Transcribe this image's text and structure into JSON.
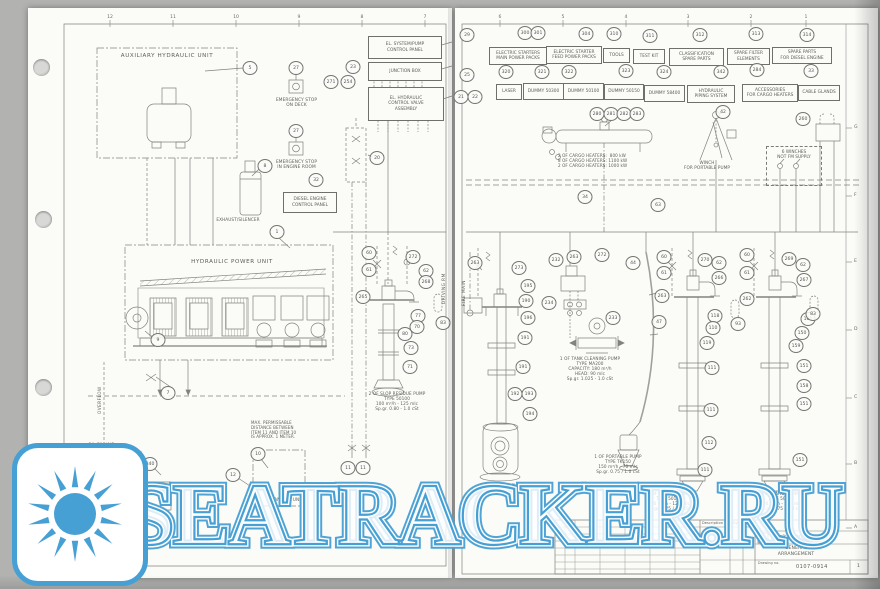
{
  "watermark": {
    "text": "SEATRACKER.RU",
    "accent": "#47a0d4"
  },
  "palette": {
    "paper": "#fbfbf8",
    "backdrop": "#b2b2b0",
    "ink": "#5c5c58",
    "line": "#82827e"
  },
  "grid": {
    "left_top_numbers": [
      [
        "12",
        110
      ],
      [
        "11",
        173
      ],
      [
        "10",
        236
      ],
      [
        "9",
        299
      ],
      [
        "8",
        362
      ],
      [
        "7",
        425
      ]
    ],
    "right_top_numbers": [
      [
        "6",
        500
      ],
      [
        "5",
        563
      ],
      [
        "4",
        626
      ],
      [
        "3",
        688
      ],
      [
        "2",
        751
      ],
      [
        "1",
        806
      ]
    ],
    "right_side_letters": [
      [
        "G",
        128
      ],
      [
        "F",
        196
      ],
      [
        "E",
        262
      ],
      [
        "D",
        330
      ],
      [
        "C",
        398
      ],
      [
        "B",
        464
      ],
      [
        "A",
        528
      ]
    ]
  },
  "left_labels": {
    "aux_title": "AUXILIARY HYDRAULIC UNIT",
    "esd_deck": "EMERGENCY STOP\nON DECK",
    "esd_engine": "EMERGENCY STOP\nIN ENGINE ROOM",
    "exhaust": "EXHAUST/SILENCER",
    "diesel_panel": "DIESEL ENGINE\nCONTROL PANEL",
    "el_panel": "EL. SYSTEM/PUMP\nCONTROL PANEL",
    "junction_box": "JUNCTION BOX",
    "el_hydraulic": "EL. HYDRAULIC\nCONTROL VALVE\nASSEMBLY",
    "hpu_title": "HYDRAULIC POWER UNIT",
    "overflow": "OVERFLOW",
    "oil_filling": "OIL FILLING",
    "max_note": "MAX. PERMISSABLE\nDISTANCE BETWEEN\nITEM 11 AND ITEM 10\nIS APPROX. 1 METER.",
    "transfer_unit": "TRANSFER UNIT",
    "oil_tank": "HYDR. OIL\nST. TANK",
    "slop_note": "2 OF SLOP RESIDUE PUMP\nTYPE 50100\n100 m³/h - 125 mlc\nSp.gr. 0.80 - 1.0 cSt",
    "compartment": "DRIVING RM"
  },
  "right_labels": {
    "fire_main": "FIRE MAIN",
    "heaters_note": "2 OF CARGO HEATERS:  800 kW\n8 OF CARGO HEATERS: 1100 kW\n2 OF CARGO HEATERS: 1000 kW",
    "winch": "WINCH\nFOR PORTABLE PUMP",
    "winches_box": "6 WINCHES\nNOT FM SUPPLY",
    "tank_cleaning_note": "1 OF TANK CLEANING PUMP\nTYPE MA200\nCAPACITY: 180 m³/h\nHEAD: 90 mlc\nSp.gr. 1.025 - 1.0 cSt",
    "portable_note": "1 OF PORTABLE PUMP\nTYPE TK150\n150 m³/h - 70 mlc\nSp.gr. 0.75 / 1.0 cSt",
    "cargo1_note": "2 OF CARGO PUMPS\nTYPE 50150\n300 m³/h - 125 mlc\nSp.gr. 0.75 / 1.0 cSt",
    "cargo2_note": "12 OF CARGO PUMPS\nTYPE 50300\n850 m³/h - 125 mlc\nSp.gr. 0.75 / 1.0 cSt",
    "ballast_note": "2 OF BALLAST PUMPS"
  },
  "title_block": {
    "company": "Frank Mohn AS",
    "doc_title": "GENERAL\nARRANGEMENT",
    "drawing_no": "0107-0914",
    "rev": "1",
    "col_description": "Description",
    "col_sign": "Sign",
    "col_date": "Date",
    "drawing_no_label": "Drawing no."
  },
  "parts_boxes": [
    {
      "label": "ELECTRIC STARTERS\nMAIN POWER PACKS",
      "x": 489,
      "y": 47,
      "w": 54,
      "h": 14,
      "nums": [
        [
          "300",
          525,
          33
        ],
        [
          "301",
          538,
          33
        ]
      ]
    },
    {
      "label": "ELECTRIC STARTER\nFEED POWER PACKS",
      "x": 546,
      "y": 46,
      "w": 52,
      "h": 14,
      "nums": [
        [
          "304",
          586,
          34
        ]
      ]
    },
    {
      "label": "TOOLS",
      "x": 603,
      "y": 48,
      "w": 23,
      "h": 11,
      "nums": [
        [
          "310",
          614,
          34
        ]
      ]
    },
    {
      "label": "TEST KIT",
      "x": 633,
      "y": 49,
      "w": 28,
      "h": 11,
      "nums": [
        [
          "311",
          650,
          36
        ]
      ]
    },
    {
      "label": "CLASSIFICATION\nSPARE PARTS",
      "x": 669,
      "y": 48,
      "w": 51,
      "h": 14,
      "nums": [
        [
          "312",
          700,
          35
        ]
      ]
    },
    {
      "label": "SPARE FILTER\nELEMENTS",
      "x": 727,
      "y": 48,
      "w": 39,
      "h": 13,
      "nums": [
        [
          "313",
          756,
          34
        ]
      ]
    },
    {
      "label": "SPARE PARTS\nFOR DIESEL ENGINE",
      "x": 772,
      "y": 47,
      "w": 56,
      "h": 13,
      "nums": [
        [
          "314",
          807,
          35
        ]
      ]
    },
    {
      "label": "LASER",
      "x": 496,
      "y": 84,
      "w": 22,
      "h": 12,
      "nums": [
        [
          "320",
          506,
          72
        ]
      ]
    },
    {
      "label": "DUMMY 50300",
      "x": 523,
      "y": 83,
      "w": 37,
      "h": 13,
      "nums": [
        [
          "321",
          542,
          72
        ]
      ]
    },
    {
      "label": "DUMMY 50100",
      "x": 563,
      "y": 83,
      "w": 37,
      "h": 13,
      "nums": [
        [
          "322",
          569,
          72
        ]
      ]
    },
    {
      "label": "DUMMY 50150",
      "x": 604,
      "y": 84,
      "w": 36,
      "h": 12,
      "nums": [
        [
          "323",
          626,
          71
        ]
      ]
    },
    {
      "label": "DUMMY 58400",
      "x": 644,
      "y": 85,
      "w": 37,
      "h": 13,
      "nums": [
        [
          "324",
          664,
          72
        ]
      ]
    },
    {
      "label": "HYDRAULIC\nPIPING SYSTEM",
      "x": 687,
      "y": 85,
      "w": 44,
      "h": 14,
      "nums": [
        [
          "342",
          721,
          72
        ]
      ]
    },
    {
      "label": "ACCESSORIES\nFOR CARGO HEATERS",
      "x": 742,
      "y": 84,
      "w": 52,
      "h": 14,
      "nums": [
        [
          "284",
          757,
          70
        ]
      ]
    },
    {
      "label": "CABLE GLANDS",
      "x": 798,
      "y": 85,
      "w": 38,
      "h": 12,
      "nums": [
        [
          "33",
          811,
          71
        ]
      ]
    }
  ],
  "callouts": [
    [
      "5",
      250,
      68
    ],
    [
      "27",
      296,
      68
    ],
    [
      "27",
      296,
      131
    ],
    [
      "8",
      265,
      166
    ],
    [
      "32",
      316,
      180
    ],
    [
      "23",
      353,
      67
    ],
    [
      "254",
      348,
      82
    ],
    [
      "271",
      331,
      82
    ],
    [
      "20",
      377,
      158
    ],
    [
      "1",
      277,
      232
    ],
    [
      "9",
      158,
      340
    ],
    [
      "7",
      168,
      393
    ],
    [
      "340",
      150,
      464
    ],
    [
      "10",
      258,
      454
    ],
    [
      "12",
      233,
      475
    ],
    [
      "11",
      348,
      468
    ],
    [
      "11",
      363,
      468
    ],
    [
      "60",
      369,
      253
    ],
    [
      "61",
      369,
      270
    ],
    [
      "272",
      413,
      257
    ],
    [
      "62",
      426,
      271
    ],
    [
      "265",
      363,
      297
    ],
    [
      "268",
      426,
      282
    ],
    [
      "77",
      418,
      316
    ],
    [
      "70",
      417,
      327
    ],
    [
      "80",
      405,
      334
    ],
    [
      "73",
      411,
      348
    ],
    [
      "71",
      410,
      367
    ],
    [
      "83",
      443,
      323
    ],
    [
      "29",
      467,
      35
    ],
    [
      "25",
      467,
      75
    ],
    [
      "21",
      461,
      97
    ],
    [
      "22",
      475,
      97
    ],
    [
      "280",
      597,
      114
    ],
    [
      "281",
      611,
      114
    ],
    [
      "282",
      624,
      114
    ],
    [
      "283",
      637,
      114
    ],
    [
      "42",
      723,
      112
    ],
    [
      "260",
      803,
      119
    ],
    [
      "34",
      585,
      197
    ],
    [
      "63",
      658,
      205
    ],
    [
      "263",
      475,
      263
    ],
    [
      "273",
      519,
      268
    ],
    [
      "195",
      528,
      286
    ],
    [
      "190",
      526,
      301
    ],
    [
      "196",
      528,
      318
    ],
    [
      "191",
      525,
      338
    ],
    [
      "191",
      523,
      367
    ],
    [
      "192",
      515,
      394
    ],
    [
      "193",
      529,
      394
    ],
    [
      "194",
      530,
      414
    ],
    [
      "232",
      556,
      260
    ],
    [
      "263",
      574,
      257
    ],
    [
      "272",
      602,
      255
    ],
    [
      "44",
      633,
      263
    ],
    [
      "234",
      549,
      303
    ],
    [
      "233",
      613,
      318
    ],
    [
      "47",
      659,
      322
    ],
    [
      "60",
      664,
      257
    ],
    [
      "61",
      664,
      273
    ],
    [
      "270",
      705,
      260
    ],
    [
      "62",
      719,
      263
    ],
    [
      "266",
      719,
      278
    ],
    [
      "263",
      662,
      296
    ],
    [
      "118",
      715,
      316
    ],
    [
      "110",
      713,
      328
    ],
    [
      "119",
      707,
      343
    ],
    [
      "93",
      738,
      324
    ],
    [
      "111",
      712,
      368
    ],
    [
      "111",
      711,
      410
    ],
    [
      "112",
      709,
      443
    ],
    [
      "111",
      705,
      470
    ],
    [
      "60",
      747,
      255
    ],
    [
      "61",
      747,
      273
    ],
    [
      "269",
      789,
      259
    ],
    [
      "62",
      803,
      265
    ],
    [
      "267",
      804,
      280
    ],
    [
      "262",
      747,
      299
    ],
    [
      "160",
      808,
      319
    ],
    [
      "150",
      802,
      333
    ],
    [
      "159",
      796,
      346
    ],
    [
      "151",
      804,
      366
    ],
    [
      "158",
      804,
      386
    ],
    [
      "151",
      804,
      404
    ],
    [
      "83",
      813,
      314
    ],
    [
      "151",
      800,
      460
    ]
  ]
}
